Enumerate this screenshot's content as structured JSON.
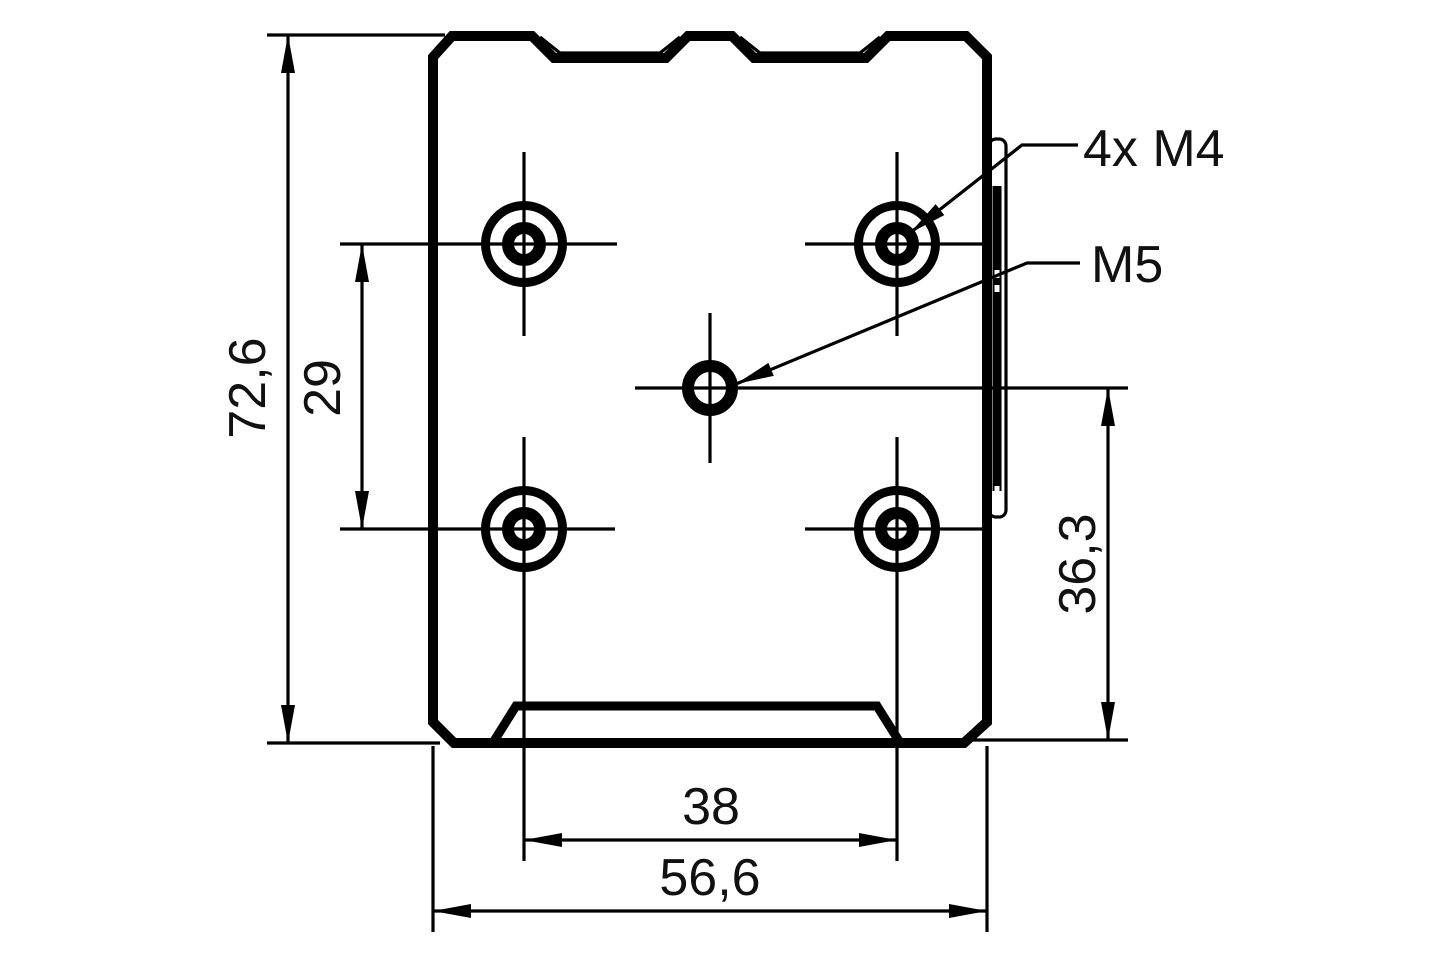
{
  "page": {
    "background": "#ffffff",
    "line_color": "#000000",
    "text_color": "#111111"
  },
  "drawing": {
    "dimensions": {
      "overall_height": {
        "label": "72,6"
      },
      "hole_row_spacing": {
        "label": "29"
      },
      "hole_column_spacing": {
        "label": "38"
      },
      "overall_width": {
        "label": "56,6"
      },
      "center_to_bottom": {
        "label": "36,3"
      }
    },
    "callouts": {
      "corner_holes": {
        "label": "4x M4"
      },
      "center_hole": {
        "label": "M5"
      }
    }
  }
}
